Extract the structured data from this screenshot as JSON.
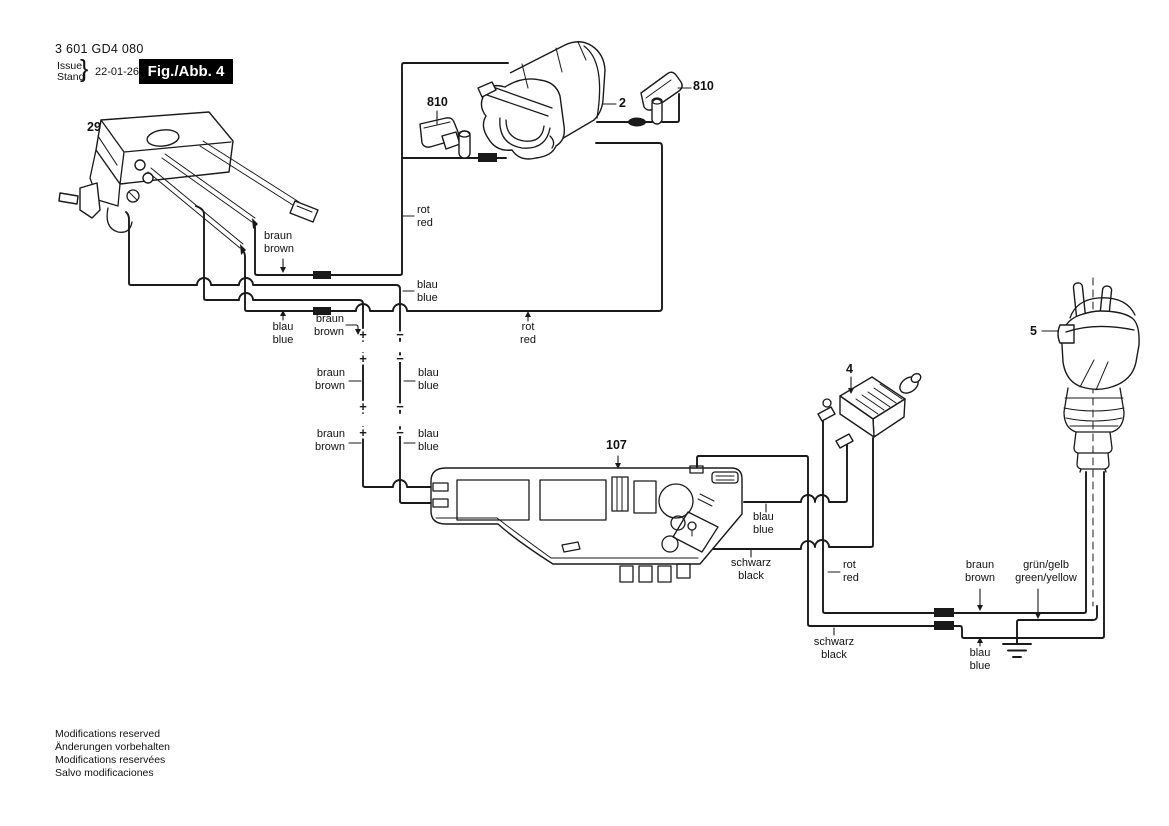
{
  "header": {
    "part_number": "3 601 GD4 080",
    "issue_label": "Issue",
    "stand_label": "Stand",
    "brace": "}",
    "date": "22-01-26",
    "figure_badge": "Fig./Abb. 4"
  },
  "parts": {
    "switch": "29",
    "field": "2",
    "brush_left": "810",
    "brush_right": "810",
    "module": "4",
    "electronics": "107",
    "plug": "5"
  },
  "wire_labels": {
    "rot": {
      "de": "rot",
      "en": "red"
    },
    "braun": {
      "de": "braun",
      "en": "brown"
    },
    "blau": {
      "de": "blau",
      "en": "blue"
    },
    "schwarz": {
      "de": "schwarz",
      "en": "black"
    },
    "gruen_gelb": {
      "de": "grün/gelb",
      "en": "green/yellow"
    }
  },
  "polarity": {
    "plus": "+",
    "minus": "−"
  },
  "footer": {
    "lines": [
      "Modifications reserved",
      "Änderungen vorbehalten",
      "Modifications reservées",
      "Salvo modificaciones"
    ]
  },
  "colors": {
    "line": "#1a1a1a",
    "background": "#ffffff",
    "badge_bg": "#000000",
    "badge_text": "#ffffff"
  }
}
